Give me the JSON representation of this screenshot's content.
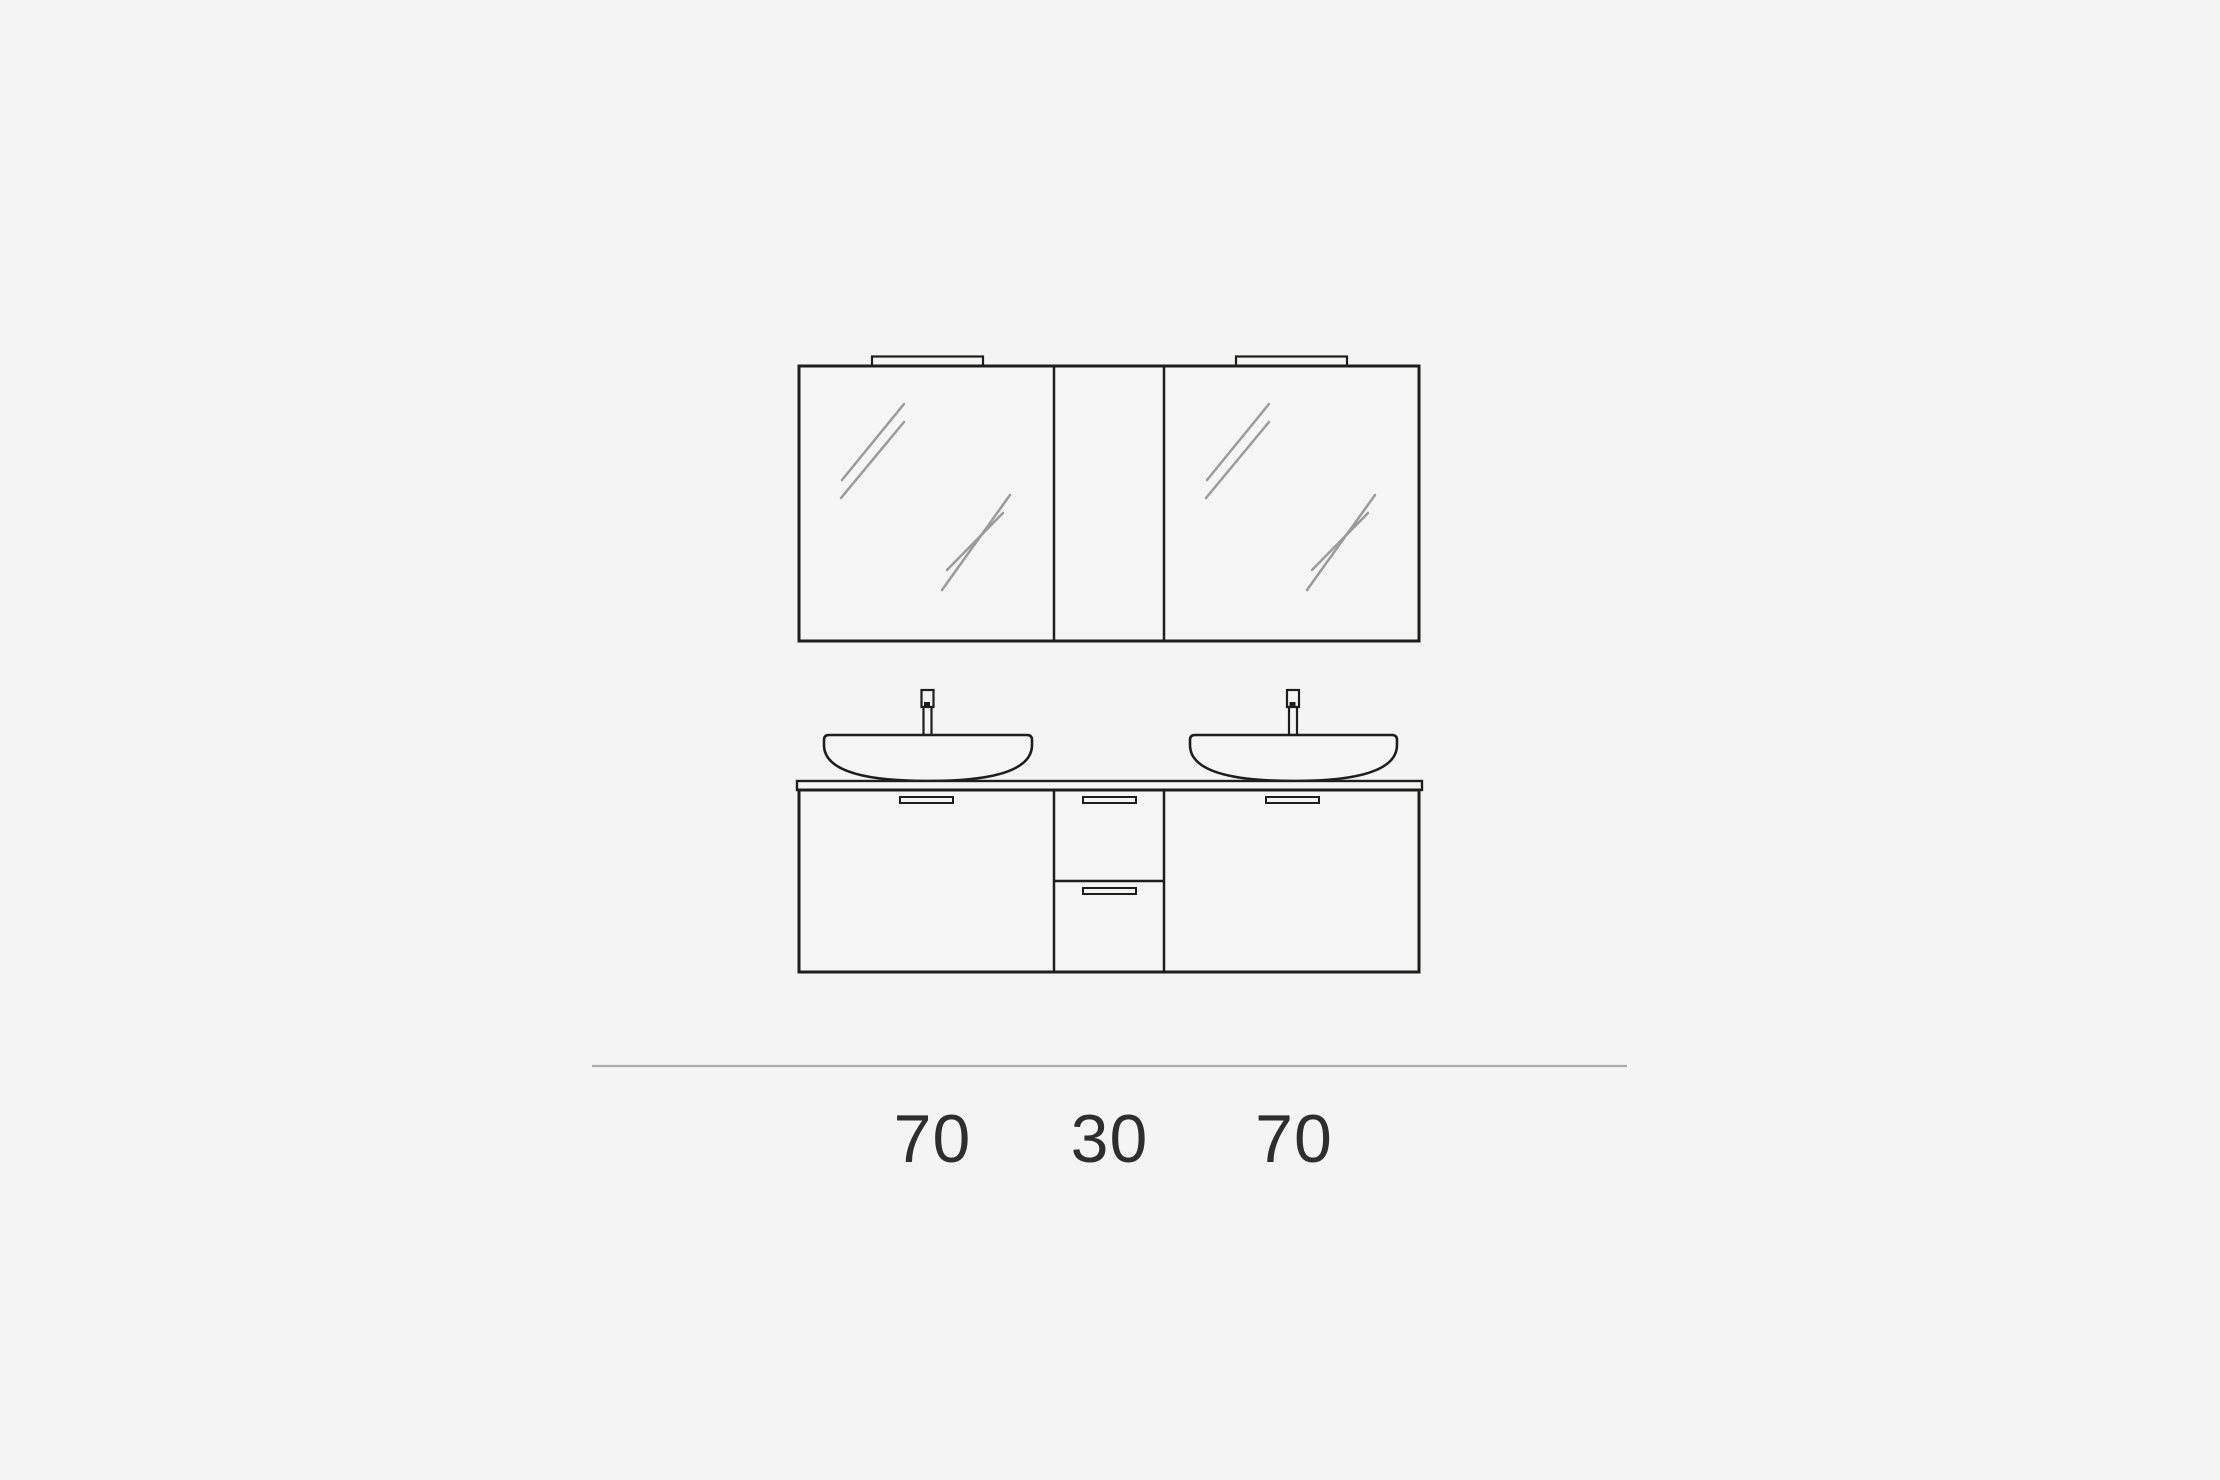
{
  "colors": {
    "background": "#f4f4f4",
    "fill": "#f5f5f5",
    "line": "#1e1e1c",
    "reflection": "#9b9b9b",
    "ground_line": "#ababab",
    "label_text": "#2e2e2e"
  },
  "diagram": {
    "kind": "bathroom-vanity-front-elevation",
    "dimension_labels": [
      "70",
      "30",
      "70"
    ]
  }
}
